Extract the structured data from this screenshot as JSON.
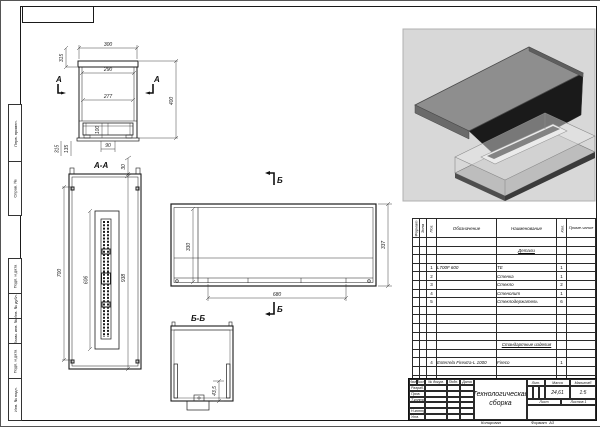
{
  "frame": {
    "left_labels": [
      "Перв. примен.",
      "Справ. №",
      "Подп. и дата",
      "Инв. № дубл.",
      "Взам. инв. №",
      "Подп. и дата",
      "Инв. № подл."
    ],
    "copied_label": "Копировал",
    "format_label": "Формат",
    "format_value": "А3"
  },
  "views": {
    "front": {
      "section_letter": "А",
      "dim_top": "300",
      "dim_mid": "290",
      "dim_inner": "277",
      "dim_height": "400",
      "dim_cap": "315",
      "dim_burner_h": "100",
      "dim_bottom": "90",
      "dim_left_full": "315",
      "dim_left_inner": "135"
    },
    "section_aa": {
      "title": "А-А",
      "dim_cap": "30",
      "dim_left": "700",
      "dim_opening": "606",
      "dim_total": "938"
    },
    "side": {
      "marker": "Б",
      "dim_left": "330",
      "dim_right": "337",
      "dim_bottom": "680"
    },
    "section_bb": {
      "title": "Б-Б",
      "dim_step": "43,5"
    }
  },
  "spec": {
    "headers": {
      "format": "Формат",
      "zone": "Зона",
      "pos": "Поз.",
      "designation": "Обозначение",
      "name": "Наименование",
      "qty": "Кол.",
      "note": "Приме-чание"
    },
    "section1": "Детали",
    "section2": "Стандартные изделия",
    "rows": [
      {
        "pos": "1",
        "designation": "L700F 600",
        "name": "ТЕ",
        "qty": "1"
      },
      {
        "pos": "2",
        "designation": "",
        "name": "Стенка",
        "qty": "1"
      },
      {
        "pos": "3",
        "designation": "",
        "name": "Стекло",
        "qty": "2"
      },
      {
        "pos": "4",
        "designation": "",
        "name": "Стенолит",
        "qty": "1"
      },
      {
        "pos": "5",
        "designation": "",
        "name": "Стеклодержатель",
        "qty": "6"
      },
      {
        "pos": "4",
        "designation": "Esterrela Firextra-L 1000",
        "name": "Fireco",
        "qty": "1"
      }
    ]
  },
  "title_block": {
    "title": "Технологическая сборка",
    "cols": [
      "Изм.",
      "Лист",
      "№ докум.",
      "Подп.",
      "Дата"
    ],
    "rows": [
      "Разраб.",
      "Пров.",
      "Т.контр.",
      "Н.контр.",
      "Утв."
    ],
    "lit_label": "Лит.",
    "mass_label": "Масса",
    "scale_label": "Масштаб",
    "mass_value": "24,61",
    "scale_value": "1:5",
    "sheet_label": "Лист",
    "sheets_label": "Листов",
    "sheets_value": "1"
  }
}
